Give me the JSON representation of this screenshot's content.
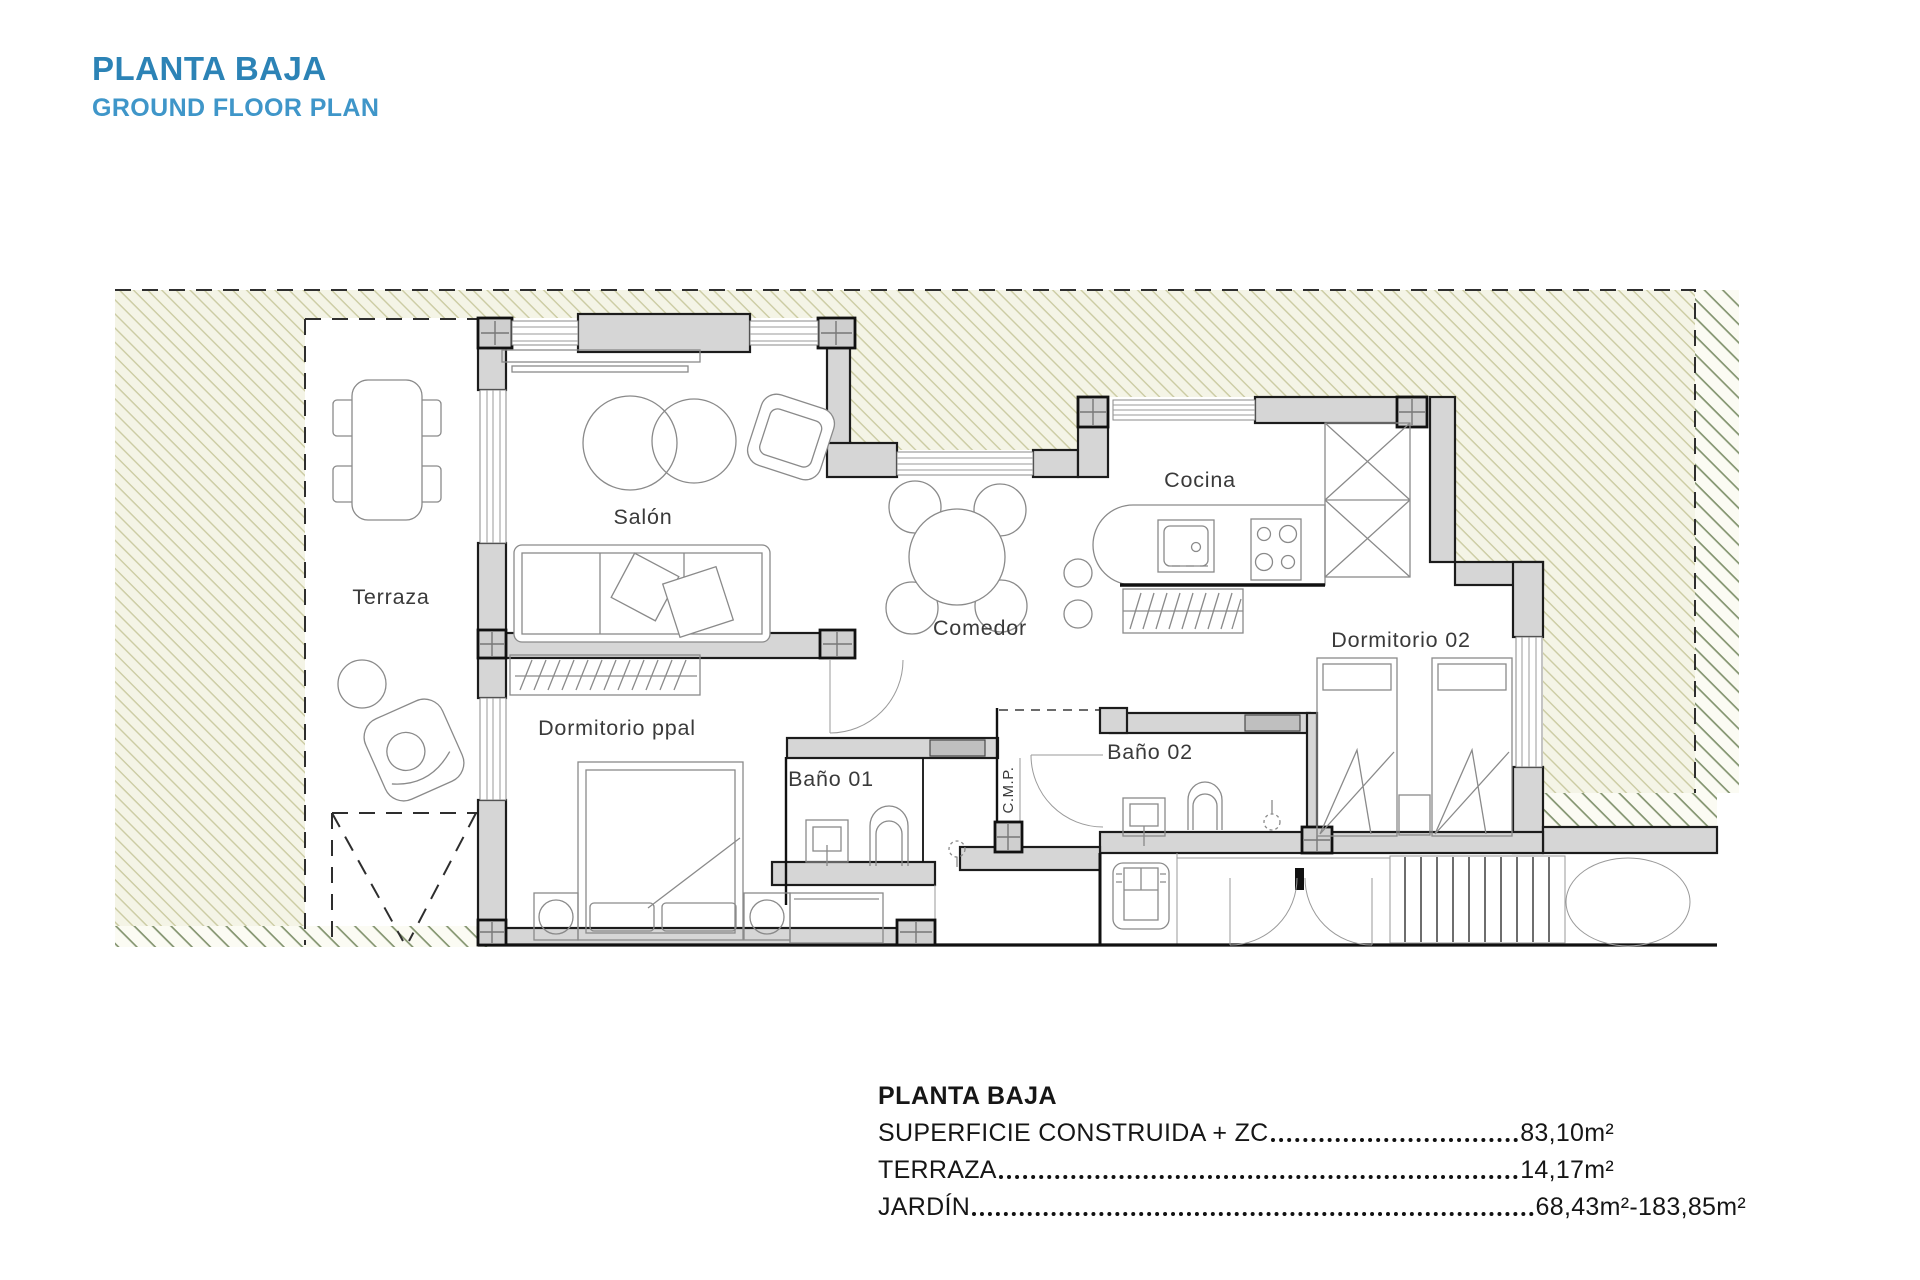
{
  "header": {
    "title": "PLANTA BAJA",
    "subtitle": "GROUND FLOOR PLAN"
  },
  "plan": {
    "rooms": [
      {
        "label": "Terraza"
      },
      {
        "label": "Salón"
      },
      {
        "label": "Cocina"
      },
      {
        "label": "Comedor"
      },
      {
        "label": "Dormitorio ppal"
      },
      {
        "label": "Baño 01"
      },
      {
        "label": "Baño 02"
      },
      {
        "label": "Dormitorio 02"
      },
      {
        "label": "C.M.P."
      }
    ]
  },
  "legend": {
    "title": "PLANTA BAJA",
    "rows": [
      {
        "label": "SUPERFICIE CONSTRUIDA + ZC",
        "value": "83,10m²"
      },
      {
        "label": "TERRAZA",
        "value": "14,17m²"
      },
      {
        "label": "JARDÍN",
        "value": "68,43m²-183,85m²"
      }
    ]
  },
  "colors": {
    "title_primary": "#2C83B6",
    "title_secondary": "#3F96C9",
    "hatch_light_line": "#CBCBA2",
    "hatch_light_bg": "#F4F4E6",
    "hatch_dark_line": "#83946F",
    "wall_fill": "#D6D6D6",
    "line_dark": "#1C1C1C"
  }
}
